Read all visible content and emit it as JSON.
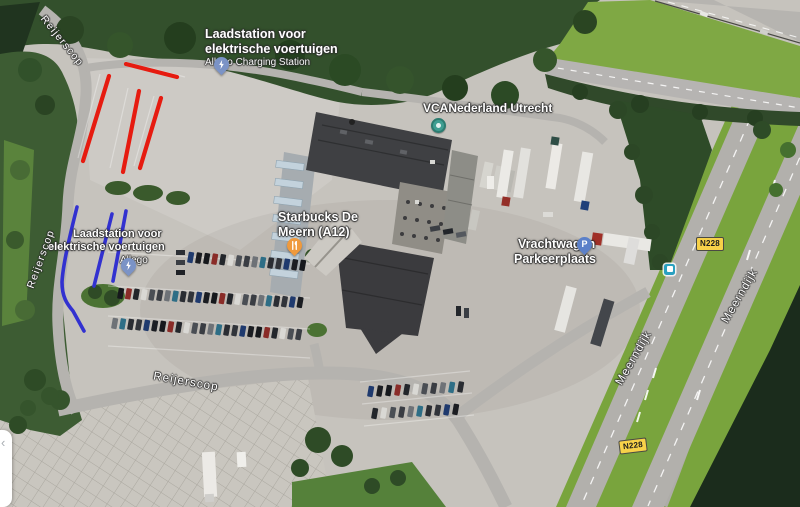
{
  "map": {
    "road_labels": {
      "reijerscop": "Reijerscop",
      "meerndijk": "Meerndijk",
      "route_badge": "N228"
    },
    "places": {
      "charging_station_top": {
        "line1": "Laadstation voor",
        "line2": "elektrische voertuigen",
        "subtitle": "Allego Charging Station",
        "pin_color": "#7b93c6",
        "icon": "ev-charging-pin"
      },
      "vca_nederland": {
        "name": "VCANederland Utrecht",
        "dot_color": "#3f9e92",
        "icon": "poi-dot"
      },
      "starbucks": {
        "line1": "Starbucks De",
        "line2": "Meern (A12)",
        "pin_color": "#ef9a3d",
        "icon": "restaurant-pin"
      },
      "charging_station_left": {
        "line1": "Laadstation voor",
        "line2": "elektrische voertuigen",
        "subtitle": "Allego",
        "pin_color": "#7b93c6",
        "icon": "ev-charging-pin"
      },
      "truck_parking": {
        "line1": "Vrachtwagen",
        "line2": "Parkeerplaats",
        "pin_letter": "P",
        "pin_color": "#5b80c9",
        "icon": "parking-pin"
      }
    },
    "transit": {
      "bus_stop_color": "#2aa0c0"
    }
  },
  "panel": {
    "chevron": "‹"
  },
  "annotations": {
    "red_color": "#e61b10",
    "red_width": 4.2,
    "blue_color": "#3231d0",
    "blue_width": 3.6,
    "red_lines": [
      [
        126,
        64,
        177,
        77
      ],
      [
        109,
        76,
        83,
        161
      ],
      [
        139,
        91,
        123,
        172
      ],
      [
        161,
        98,
        140,
        168
      ]
    ],
    "blue_lines": [
      [
        112,
        214,
        94,
        286
      ],
      [
        126,
        211,
        113,
        281
      ]
    ],
    "blue_paths": [
      "M77,207 C70,235 63,264 62,282 C62,297 67,304 73,311 L84,331"
    ]
  }
}
